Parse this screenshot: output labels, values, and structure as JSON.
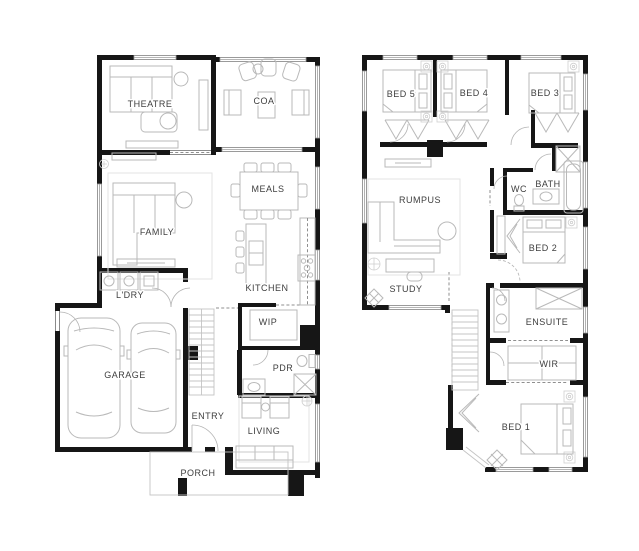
{
  "colors": {
    "wall": "#161616",
    "furniture_line": "#b9b9b9",
    "window_line": "#9e9e9e",
    "label_text": "#3e3e3e",
    "background": "#ffffff"
  },
  "floors": {
    "ground": {
      "id": "ground-floor",
      "rooms": [
        {
          "label": "THEATRE"
        },
        {
          "label": "COA"
        },
        {
          "label": "MEALS"
        },
        {
          "label": "FAMILY"
        },
        {
          "label": "KITCHEN"
        },
        {
          "label": "L'DRY"
        },
        {
          "label": "WIP"
        },
        {
          "label": "GARAGE"
        },
        {
          "label": "PDR"
        },
        {
          "label": "ENTRY"
        },
        {
          "label": "LIVING"
        },
        {
          "label": "PORCH"
        }
      ]
    },
    "first": {
      "id": "first-floor",
      "rooms": [
        {
          "label": "BED 5"
        },
        {
          "label": "BED 4"
        },
        {
          "label": "BED 3"
        },
        {
          "label": "RUMPUS"
        },
        {
          "label": "WC"
        },
        {
          "label": "BATH"
        },
        {
          "label": "BED 2"
        },
        {
          "label": "STUDY"
        },
        {
          "label": "ENSUITE"
        },
        {
          "label": "WIR"
        },
        {
          "label": "BED 1"
        }
      ]
    }
  }
}
